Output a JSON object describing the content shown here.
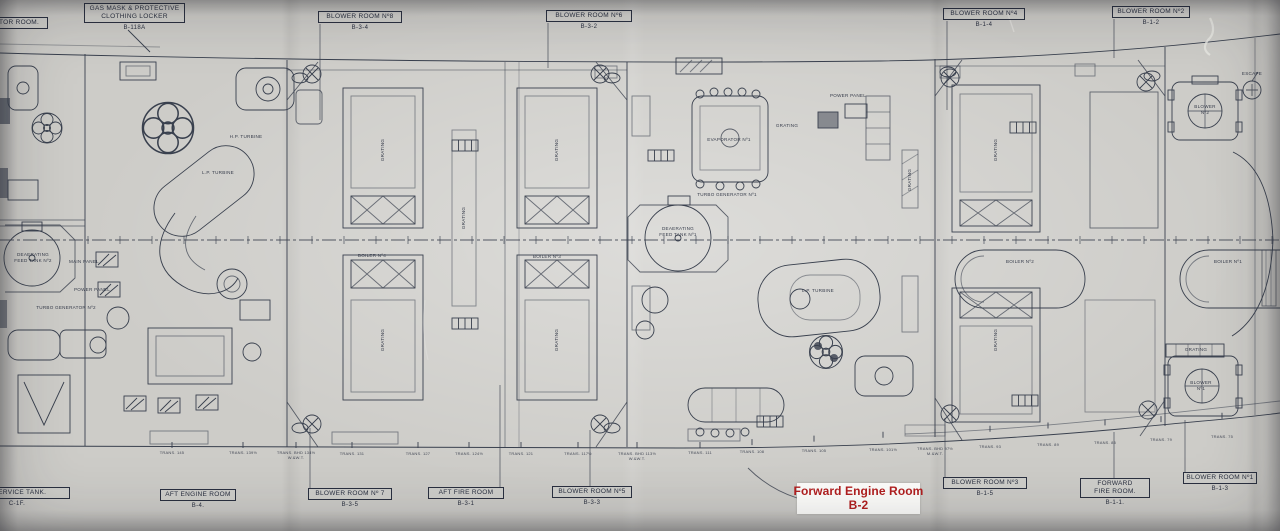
{
  "colors": {
    "ink": "#39404e",
    "ink_dark": "#2a3040",
    "paper": "#cdccc8",
    "annotation_red": "#b31f1f",
    "annotation_bg": "#fefefc"
  },
  "annotation": {
    "line1": "Forward Engine Room",
    "line2": "B-2"
  },
  "callouts_top": [
    {
      "label": "ATOR ROOM.",
      "code": "",
      "x": -14,
      "y": 17,
      "w": 62
    },
    {
      "label": "GAS MASK & PROTECTIVE\nCLOTHING LOCKER",
      "code": "B-118A",
      "x": 84,
      "y": 3,
      "w": 101
    },
    {
      "label": "BLOWER ROOM Nº8",
      "code": "B-3-4",
      "x": 318,
      "y": 11,
      "w": 84
    },
    {
      "label": "BLOWER ROOM Nº6",
      "code": "B-3-2",
      "x": 546,
      "y": 10,
      "w": 86
    },
    {
      "label": "BLOWER ROOM Nº4",
      "code": "B-1-4",
      "x": 943,
      "y": 8,
      "w": 82
    },
    {
      "label": "BLOWER ROOM Nº2",
      "code": "B-1-2",
      "x": 1112,
      "y": 6,
      "w": 78
    }
  ],
  "callouts_bottom": [
    {
      "label": "L SERVICE TANK.",
      "code": "C-1F.",
      "x": -36,
      "y": 487,
      "w": 106
    },
    {
      "label": "AFT ENGINE ROOM",
      "code": "B-4.",
      "x": 160,
      "y": 489,
      "w": 76
    },
    {
      "label": "BLOWER ROOM Nº 7",
      "code": "B-3-5",
      "x": 308,
      "y": 488,
      "w": 84
    },
    {
      "label": "AFT FIRE ROOM",
      "code": "B-3-1",
      "x": 428,
      "y": 487,
      "w": 76
    },
    {
      "label": "BLOWER ROOM Nº5",
      "code": "B-3-3",
      "x": 552,
      "y": 486,
      "w": 80
    },
    {
      "label": "BLOWER ROOM Nº3",
      "code": "B-1-5",
      "x": 943,
      "y": 477,
      "w": 84
    },
    {
      "label": "FORWARD\nFIRE ROOM.",
      "code": "B-1-1.",
      "x": 1080,
      "y": 478,
      "w": 70
    },
    {
      "label": "BLOWER ROOM Nº1",
      "code": "B-1-3",
      "x": 1183,
      "y": 472,
      "w": 74
    }
  ],
  "equipment_labels": [
    {
      "t": "BOILER Nº4",
      "x": 372,
      "y": 256
    },
    {
      "t": "BOILER Nº3",
      "x": 547,
      "y": 257
    },
    {
      "t": "BOILER Nº2",
      "x": 1020,
      "y": 262
    },
    {
      "t": "BOILER Nº1",
      "x": 1228,
      "y": 262
    },
    {
      "t": "DEAERATING\nFEED TANK Nº1",
      "x": 678,
      "y": 232
    },
    {
      "t": "DEAERATING\nFEED TANK Nº2",
      "x": 33,
      "y": 258
    },
    {
      "t": "TURBO GENERATOR Nº1",
      "x": 727,
      "y": 195
    },
    {
      "t": "TURBO GENERATOR Nº2",
      "x": 66,
      "y": 308
    },
    {
      "t": "L.P. TURBINE",
      "x": 218,
      "y": 173
    },
    {
      "t": "H.P. TURBINE",
      "x": 246,
      "y": 137
    },
    {
      "t": "L.P. TURBINE",
      "x": 818,
      "y": 291
    },
    {
      "t": "EVAPORATOR Nº1",
      "x": 729,
      "y": 140
    },
    {
      "t": "POWER PANEL",
      "x": 848,
      "y": 96
    },
    {
      "t": "MAIN PANEL",
      "x": 84,
      "y": 262
    },
    {
      "t": "POWER PANEL",
      "x": 92,
      "y": 290
    },
    {
      "t": "ESCAPE",
      "x": 1252,
      "y": 74
    },
    {
      "t": "BLOWER\nNº2",
      "x": 1205,
      "y": 110
    },
    {
      "t": "BLOWER\nNº1",
      "x": 1201,
      "y": 386
    },
    {
      "t": "GRATING",
      "x": 383,
      "y": 150,
      "vert": true
    },
    {
      "t": "GRATING",
      "x": 557,
      "y": 150,
      "vert": true
    },
    {
      "t": "GRATING",
      "x": 383,
      "y": 340,
      "vert": true
    },
    {
      "t": "GRATING",
      "x": 557,
      "y": 340,
      "vert": true
    },
    {
      "t": "GRATING",
      "x": 464,
      "y": 218,
      "vert": true
    },
    {
      "t": "GRATING",
      "x": 996,
      "y": 150,
      "vert": true
    },
    {
      "t": "GRATING",
      "x": 996,
      "y": 340,
      "vert": true
    },
    {
      "t": "GRATING",
      "x": 910,
      "y": 180,
      "vert": true
    },
    {
      "t": "GRATING",
      "x": 787,
      "y": 126
    },
    {
      "t": "GRATING",
      "x": 1196,
      "y": 350
    }
  ],
  "frame_labels": [
    {
      "t": "TRANS. 145",
      "x": 172,
      "y": 450
    },
    {
      "t": "TRANS. 139½",
      "x": 243,
      "y": 450
    },
    {
      "t": "TRANS. BHD 134½\nW.&W.T.",
      "x": 296,
      "y": 450
    },
    {
      "t": "TRANS. 131",
      "x": 352,
      "y": 451
    },
    {
      "t": "TRANS. 127",
      "x": 418,
      "y": 451
    },
    {
      "t": "TRANS. 124½",
      "x": 469,
      "y": 451
    },
    {
      "t": "TRANS. 121",
      "x": 521,
      "y": 451
    },
    {
      "t": "TRANS. 117½",
      "x": 578,
      "y": 451
    },
    {
      "t": "TRANS. BHD 113½\nW.&W.T.",
      "x": 637,
      "y": 451
    },
    {
      "t": "TRANS. 111",
      "x": 700,
      "y": 450
    },
    {
      "t": "TRANS. 108",
      "x": 752,
      "y": 449
    },
    {
      "t": "TRANS. 105",
      "x": 814,
      "y": 448
    },
    {
      "t": "TRANS. 101½",
      "x": 883,
      "y": 447
    },
    {
      "t": "TRANS. BHD 97½\nM.&W.T.",
      "x": 935,
      "y": 446
    },
    {
      "t": "TRANS. 93",
      "x": 990,
      "y": 444
    },
    {
      "t": "TRANS. 89",
      "x": 1048,
      "y": 442
    },
    {
      "t": "TRANS. 85",
      "x": 1105,
      "y": 440
    },
    {
      "t": "TRANS. 79",
      "x": 1161,
      "y": 437
    },
    {
      "t": "TRANS. 75",
      "x": 1222,
      "y": 434
    }
  ]
}
